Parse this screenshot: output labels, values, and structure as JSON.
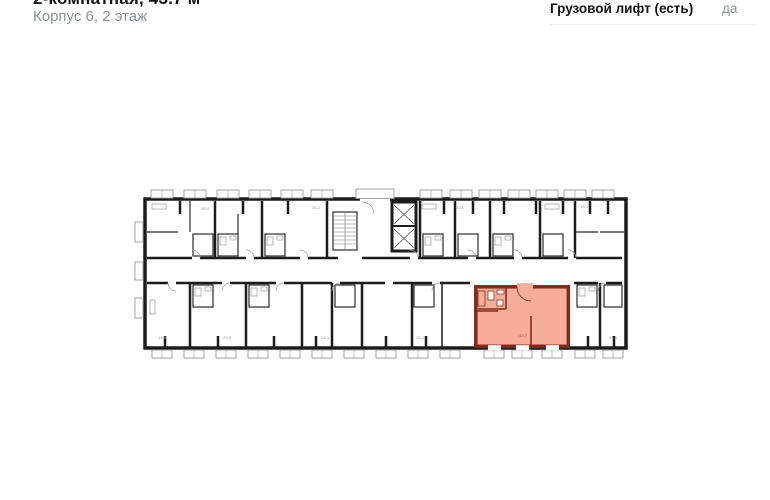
{
  "header": {
    "title": "2-комнатная, 43.7 м²",
    "subtitle": "Корпус 6, 2 этаж",
    "info_label": "Грузовой лифт (есть)",
    "info_value": "да"
  },
  "plan": {
    "wall_color": "#1b1b1b",
    "highlight_fill": "#f7ae98",
    "highlight_wall": "#7e2b1a",
    "window_stroke": "#9a9a9a",
    "areas": [
      {
        "value": "38.4"
      },
      {
        "value": "36.2"
      },
      {
        "value": "30.1"
      },
      {
        "value": "38.3"
      },
      {
        "value": "34.3"
      },
      {
        "value": "29.8"
      },
      {
        "value": "38.4"
      },
      {
        "value": "25.4"
      },
      {
        "value": "41.3"
      },
      {
        "value": "43.7"
      }
    ]
  }
}
